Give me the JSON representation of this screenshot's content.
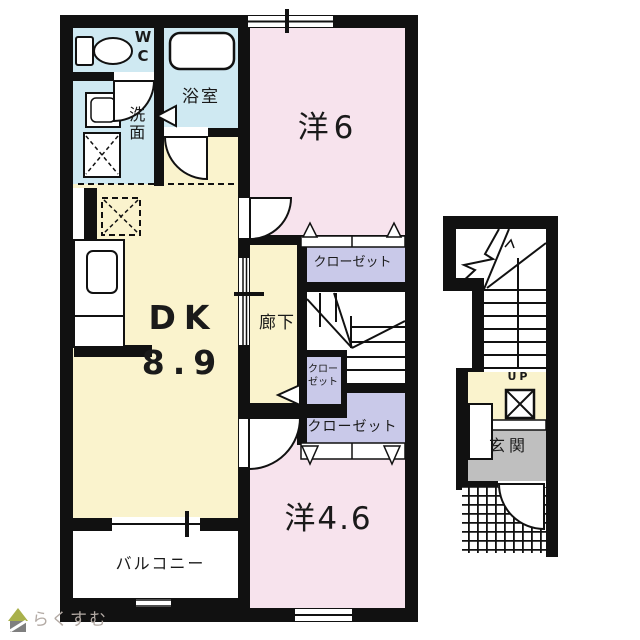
{
  "colors": {
    "wall": "#111111",
    "water_blue": "#cfe9f2",
    "room_pink": "#f7e3ed",
    "dk_yellow": "#faf3cd",
    "closet_lavender": "#c9c9e9",
    "entrance_gray": "#bfbfbf",
    "logo_text": "#b3aaa4",
    "logo_roof": "#a9b14b",
    "logo_body": "#7f7f7f"
  },
  "rooms": {
    "wc": {
      "label_line1": "W",
      "label_line2": "C"
    },
    "bathroom": {
      "label": "浴室"
    },
    "washroom": {
      "label": "洗面"
    },
    "western6": {
      "label": "洋6"
    },
    "dk": {
      "label": "DK",
      "size": "8.9"
    },
    "hallway": {
      "label": "廊下"
    },
    "closet_upper": {
      "label": "クローゼット"
    },
    "closet_small": {
      "label_line1": "クロー",
      "label_line2": "ゼット"
    },
    "closet_lower": {
      "label": "クローゼット"
    },
    "western46": {
      "label": "洋4.6"
    },
    "balcony": {
      "label": "バルコニー"
    },
    "entrance_hall": {
      "label": "玄関"
    },
    "stairs": {
      "direction_label": "UP"
    }
  },
  "logo": {
    "text": "らくすむ"
  }
}
